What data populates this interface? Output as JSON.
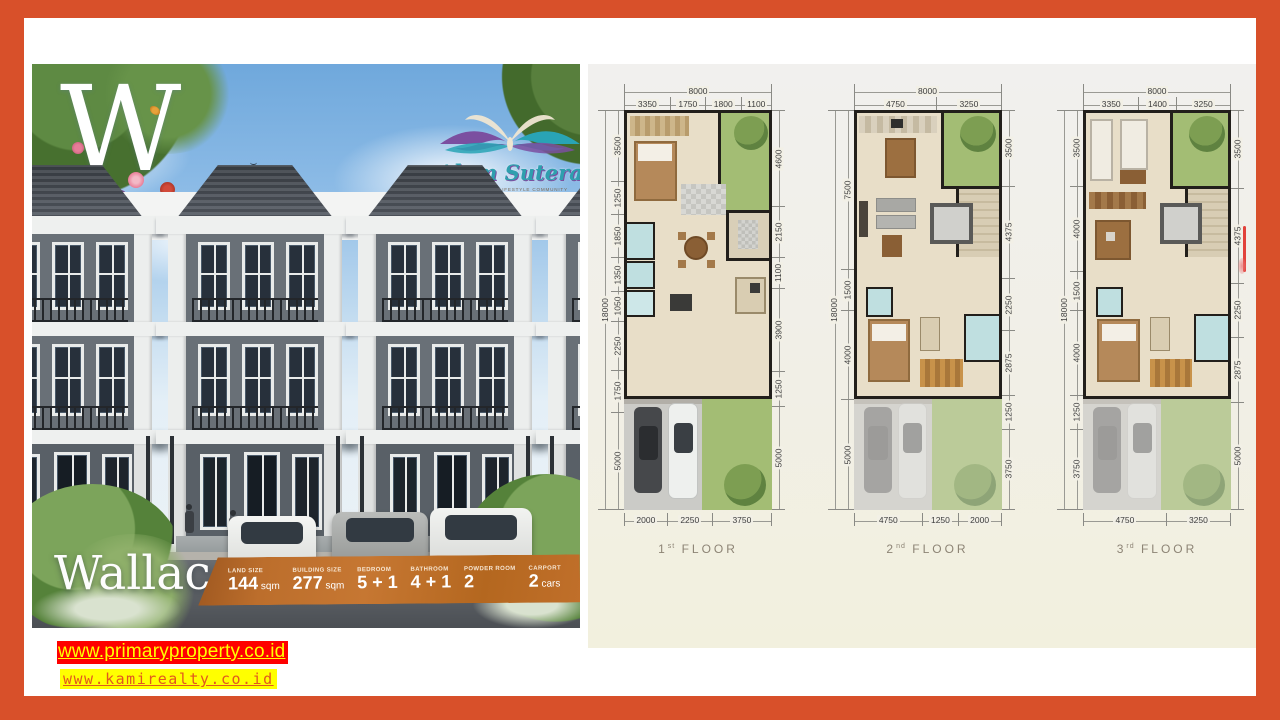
{
  "brand": {
    "monogram": "W",
    "logo_name": "Alam Sutera",
    "logo_tagline": "RESIDENTIAL & LIFESTYLE COMMUNITY"
  },
  "property": {
    "name": "Wallace"
  },
  "specs": {
    "items": [
      {
        "label": "LAND SIZE",
        "value": "144",
        "unit": "sqm"
      },
      {
        "label": "BUILDING SIZE",
        "value": "277",
        "unit": "sqm"
      },
      {
        "label": "BEDROOM",
        "value": "5 + 1",
        "unit": ""
      },
      {
        "label": "BATHROOM",
        "value": "4 + 1",
        "unit": ""
      },
      {
        "label": "POWDER ROOM",
        "value": "2",
        "unit": ""
      },
      {
        "label": "CARPORT",
        "value": "2",
        "unit": "cars"
      }
    ]
  },
  "links": [
    {
      "text": "www.primaryproperty.co.id",
      "style": "red-yellow"
    },
    {
      "text": "www.kamirealty.co.id",
      "style": "yellow-orange"
    }
  ],
  "floor_plans": [
    {
      "num": "1",
      "ordinal": "st",
      "floor_word": "FLOOR",
      "width_total": "8000",
      "height_total": "18000",
      "top_dims": [
        "3350",
        "1750",
        "1800",
        "1100"
      ],
      "left_dims": [
        "3500",
        "1250",
        "1850",
        "1350",
        "1050",
        "2250",
        "1750",
        "5000"
      ],
      "right_dims": [
        "4600",
        "2150",
        "1100",
        "3900",
        "1250",
        "5000"
      ],
      "bottom_dims": [
        "2000",
        "2250",
        "3750"
      ]
    },
    {
      "num": "2",
      "ordinal": "nd",
      "floor_word": "FLOOR",
      "width_total": "8000",
      "height_total": "18000",
      "top_dims": [
        "4750",
        "3250"
      ],
      "left_dims": [
        "7500",
        "1500",
        "4000",
        "5000"
      ],
      "right_dims": [
        "3500",
        "4375",
        "2250",
        "2875",
        "1250",
        "3750"
      ],
      "bottom_dims": [
        "4750",
        "1250",
        "2000"
      ]
    },
    {
      "num": "3",
      "ordinal": "rd",
      "floor_word": "FLOOR",
      "width_total": "8000",
      "height_total": "18000",
      "top_dims": [
        "3350",
        "1400",
        "3250"
      ],
      "left_dims": [
        "3500",
        "4000",
        "1500",
        "4000",
        "1250",
        "3750"
      ],
      "right_dims": [
        "3500",
        "4375",
        "2250",
        "2875",
        "5000"
      ],
      "bottom_dims": [
        "4750",
        "3250"
      ]
    }
  ],
  "colors": {
    "frame": "#d8502a",
    "banner": "#bc6e2c",
    "plan_green": "#a3bd74",
    "plan_beige": "#e8dec8",
    "link1_bg": "#fe0000",
    "link1_fg": "#ffff00",
    "link2_bg": "#ffff00",
    "link2_fg": "#e2581d"
  }
}
